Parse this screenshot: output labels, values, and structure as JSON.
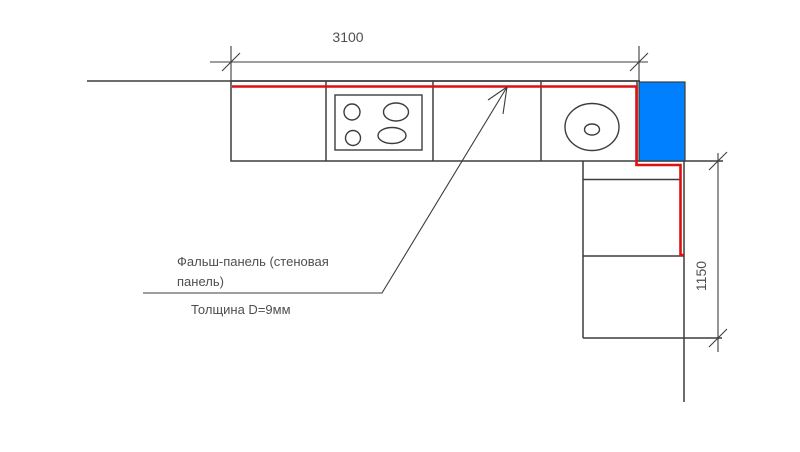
{
  "drawing": {
    "dimensions": {
      "top_width": "3100",
      "right_height": "1150"
    },
    "annotations": {
      "panel_label_line1": "Фальш-панель (стеновая",
      "panel_label_line2": "панель)",
      "thickness_note": "Толщина D=9мм"
    },
    "colors": {
      "outline": "#3d3d3d",
      "panel_red": "#dd1111",
      "highlight_blue": "#0080ff",
      "text": "#4f4f4f",
      "background": "#ffffff"
    }
  }
}
